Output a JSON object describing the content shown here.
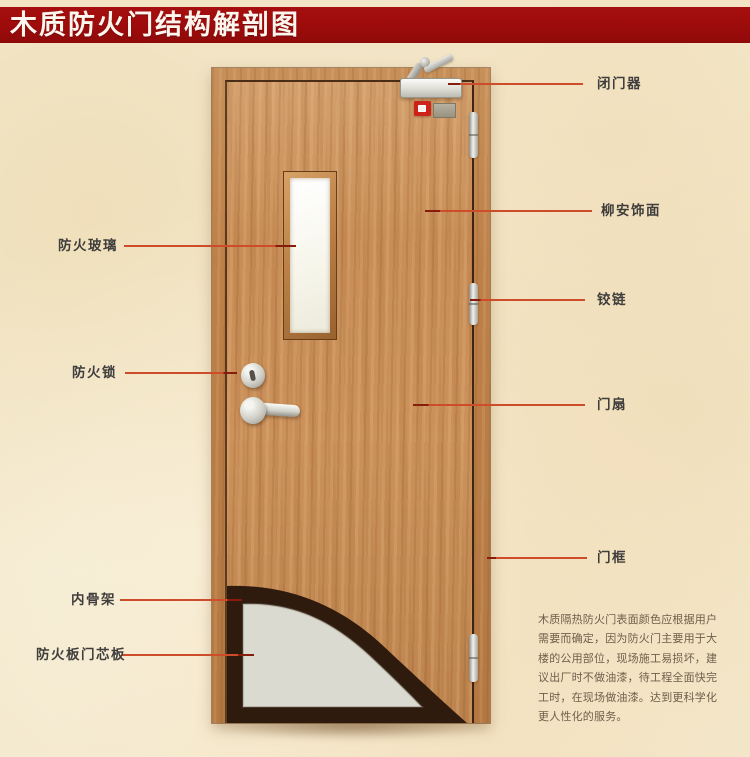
{
  "title": "木质防火门结构解剖图",
  "parts": {
    "left": [
      {
        "label": "防火玻璃"
      },
      {
        "label": "防火锁"
      },
      {
        "label": "内骨架"
      },
      {
        "label": "防火板门芯板"
      }
    ],
    "right": [
      {
        "label": "闭门器"
      },
      {
        "label": "柳安饰面"
      },
      {
        "label": "铰链"
      },
      {
        "label": "门扇"
      },
      {
        "label": "门框"
      }
    ]
  },
  "description": {
    "lines": [
      "木质隔热防火门表面颜色应根据用户",
      "需要而确定，因为防火门主要用于大",
      "楼的公用部位，现场施工易损坏，建",
      "议出厂时不做油漆，待工程全面快完",
      "工时，在现场做油漆。达到更科学化",
      "更人性化的服务。"
    ]
  },
  "colors": {
    "banner": "#9c0b0b",
    "pointer_line": "#cd4c29",
    "pointer_tip": "#851c0c",
    "door_wood": "#c98e57",
    "frame_wood": "#bd8048",
    "core_board_gray": "#dbdad0",
    "inner_skeleton_dark": "#2f1a0e",
    "background": "#f3e8cc"
  }
}
